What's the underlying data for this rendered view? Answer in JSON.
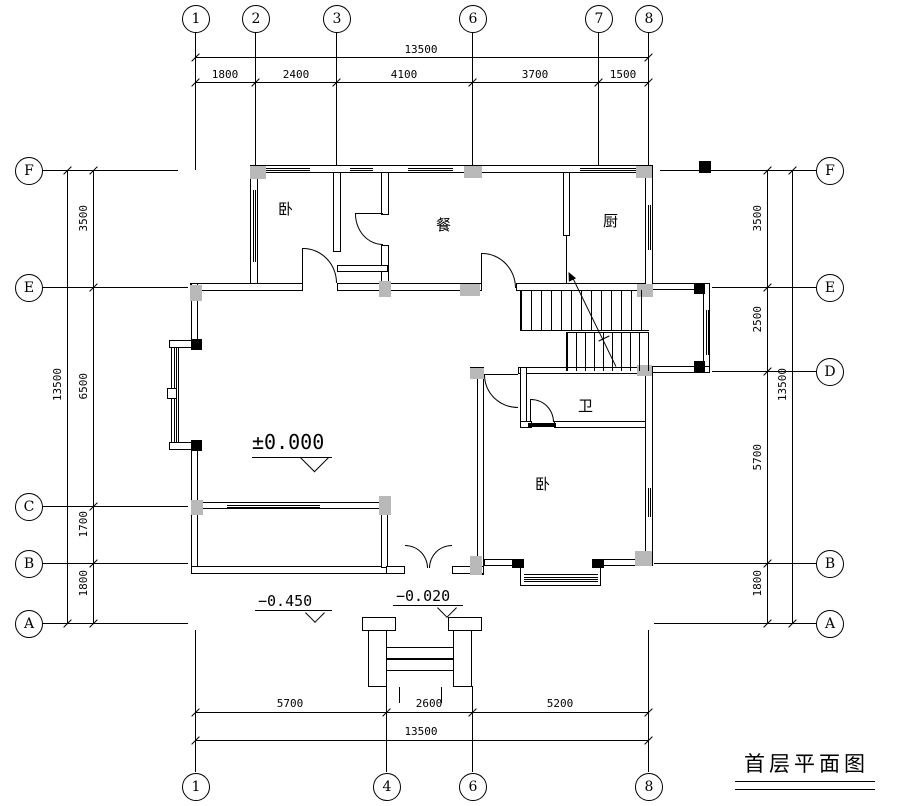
{
  "title": {
    "text": "首层平面图"
  },
  "grid": {
    "top": {
      "bubbles": [
        "1",
        "2",
        "3",
        "6",
        "7",
        "8"
      ],
      "total": "13500",
      "segments": [
        "1800",
        "2400",
        "4100",
        "3700",
        "1500"
      ]
    },
    "bottom": {
      "bubbles": [
        "1",
        "4",
        "6",
        "8"
      ],
      "total": "13500",
      "segments": [
        "5700",
        "2600",
        "5200"
      ]
    },
    "left": {
      "bubbles": [
        "F",
        "E",
        "C",
        "B",
        "A"
      ],
      "total": "13500",
      "segments": [
        "3500",
        "6500",
        "1700",
        "1800"
      ]
    },
    "right": {
      "bubbles": [
        "F",
        "E",
        "D",
        "B",
        "A"
      ],
      "total": "13500",
      "segments": [
        "3500",
        "2500",
        "5700",
        "1800"
      ]
    }
  },
  "rooms": {
    "bedroom_nw": "卧",
    "dining": "餐",
    "kitchen": "厨",
    "bathroom": "卫",
    "bedroom_se": "卧"
  },
  "levels": {
    "floor": "±0.000",
    "terrace": "−0.450",
    "porch": "−0.020"
  }
}
